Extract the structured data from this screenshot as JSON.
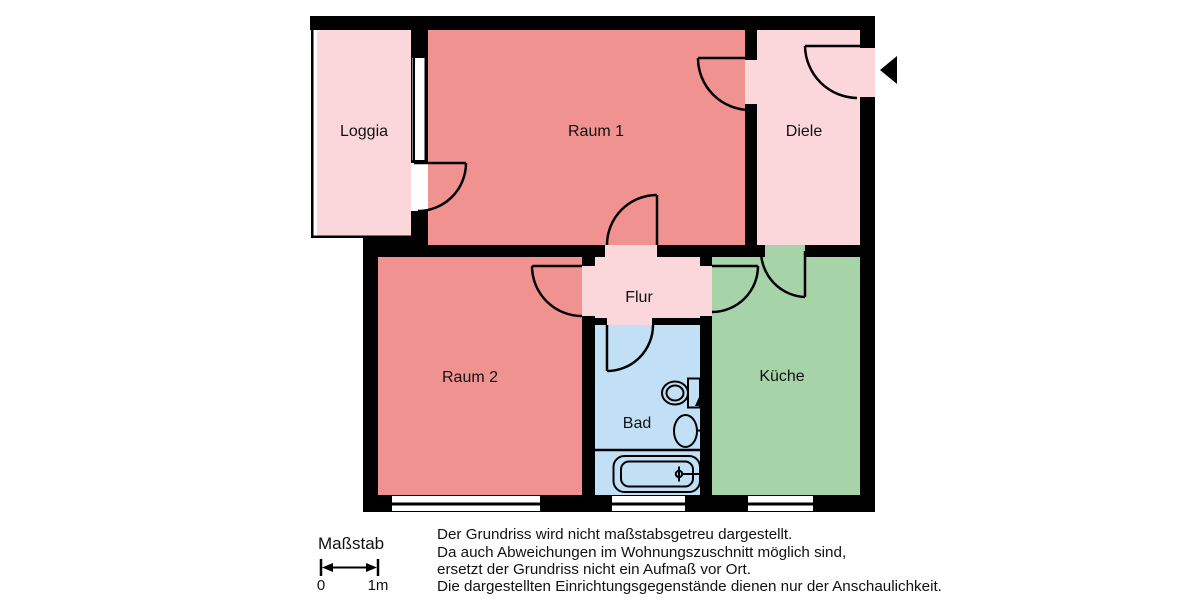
{
  "floorplan": {
    "wall_color": "#000000",
    "background": "#ffffff",
    "rooms": [
      {
        "id": "loggia",
        "label": "Loggia",
        "color": "#fbd6da"
      },
      {
        "id": "raum1",
        "label": "Raum 1",
        "color": "#f09290"
      },
      {
        "id": "diele",
        "label": "Diele",
        "color": "#fbd6da"
      },
      {
        "id": "raum2",
        "label": "Raum 2",
        "color": "#f09290"
      },
      {
        "id": "flur",
        "label": "Flur",
        "color": "#fbd6da"
      },
      {
        "id": "bad",
        "label": "Bad",
        "color": "#c2e0f5"
      },
      {
        "id": "kueche",
        "label": "Küche",
        "color": "#a6d3a8"
      }
    ],
    "fixtures": [
      "toilet-icon",
      "sink-icon",
      "bathtub-icon"
    ],
    "entrance_marker": "entrance-arrow"
  },
  "scale_bar": {
    "title": "Maßstab",
    "start_label": "0",
    "end_label": "1m"
  },
  "disclaimer": {
    "lines": [
      "Der Grundriss wird nicht maßstabsgetreu dargestellt.",
      "Da auch Abweichungen im Wohnungszuschnitt möglich sind,",
      "ersetzt der Grundriss nicht ein Aufmaß vor Ort.",
      "Die dargestellten Einrichtungsgegenstände dienen nur der Anschaulichkeit."
    ]
  }
}
